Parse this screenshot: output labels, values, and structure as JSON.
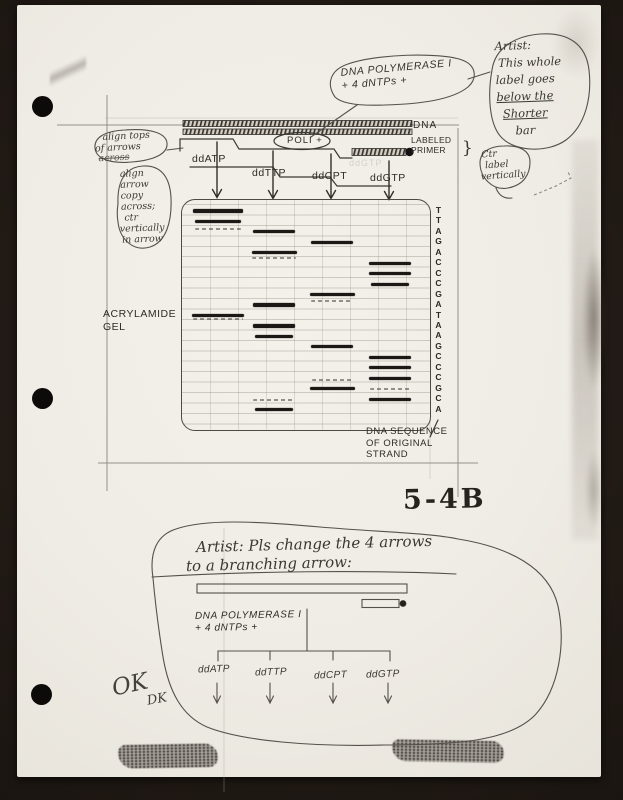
{
  "page": {
    "fig_number": "5-4B"
  },
  "top": {
    "dna_bubble": [
      "DNA POLYMERASE I",
      "+ 4 dNTPs +"
    ],
    "artist_note": [
      "Artist:",
      "This whole",
      "label goes",
      "below the",
      "Shorter",
      "bar"
    ],
    "align_tops_note": [
      "align tops",
      "of arrows",
      "across"
    ],
    "align_arrow_note": [
      "align",
      "arrow",
      "copy",
      "across;",
      "ctr",
      "vertically",
      "in arrow"
    ],
    "ctr_label_note": [
      "Ctr",
      "label",
      "vertically"
    ],
    "dna_label": "DNA",
    "poli_label": "POLI +",
    "labeled_primer": [
      "LABELED",
      "PRIMER"
    ],
    "primer_bracket": "}",
    "lanes": [
      "ddATP",
      "ddTTP",
      "ddCPT",
      "ddGTP"
    ],
    "ghost_label": "ddGTP"
  },
  "gel": {
    "left_label": [
      "ACRYLAMIDE",
      "GEL"
    ],
    "sequence_note": [
      "DNA SEQUENCE",
      "OF ORIGINAL",
      "STRAND"
    ],
    "sequence": "TTAGACCCGATAAGCCCGCA",
    "rows": [
      {
        "letter": "T",
        "lane": 1,
        "w": 50
      },
      {
        "letter": "T",
        "lane": 1,
        "w": 46
      },
      {
        "letter": "A",
        "lane": 2
      },
      {
        "letter": "G",
        "lane": 3
      },
      {
        "letter": "A",
        "lane": 2,
        "w": 45
      },
      {
        "letter": "C",
        "lane": 4
      },
      {
        "letter": "C",
        "lane": 4
      },
      {
        "letter": "C",
        "lane": 4,
        "w": 38
      },
      {
        "letter": "G",
        "lane": 3,
        "w": 45
      },
      {
        "letter": "A",
        "lane": 2
      },
      {
        "letter": "T",
        "lane": 1,
        "w": 52
      },
      {
        "letter": "A",
        "lane": 2
      },
      {
        "letter": "A",
        "lane": 2,
        "w": 38
      },
      {
        "letter": "G",
        "lane": 3
      },
      {
        "letter": "C",
        "lane": 4
      },
      {
        "letter": "C",
        "lane": 4
      },
      {
        "letter": "C",
        "lane": 4
      },
      {
        "letter": "G",
        "lane": 3,
        "w": 45
      },
      {
        "letter": "C",
        "lane": 4
      },
      {
        "letter": "A",
        "lane": 2,
        "w": 38
      }
    ],
    "faint_bands": [
      {
        "row": 2.72,
        "lane": 1,
        "w": 46
      },
      {
        "row": 5.5,
        "lane": 2,
        "w": 44
      },
      {
        "row": 9.6,
        "lane": 3,
        "w": 42
      },
      {
        "row": 11.35,
        "lane": 1,
        "w": 50
      },
      {
        "row": 17.2,
        "lane": 3,
        "w": 40
      },
      {
        "row": 18.05,
        "lane": 4,
        "w": 40
      },
      {
        "row": 19.05,
        "lane": 2,
        "w": 42
      }
    ]
  },
  "bottom": {
    "artist_note": [
      "Artist: Pls change the 4 arrows",
      "to a branching arrow:"
    ],
    "poly_label": [
      "DNA POLYMERASE I",
      "+ 4 dNTPs +"
    ],
    "lanes": [
      "ddATP",
      "ddTTP",
      "ddCPT",
      "ddGTP"
    ],
    "ok_mark": "OK",
    "ok_initials": "DK"
  }
}
